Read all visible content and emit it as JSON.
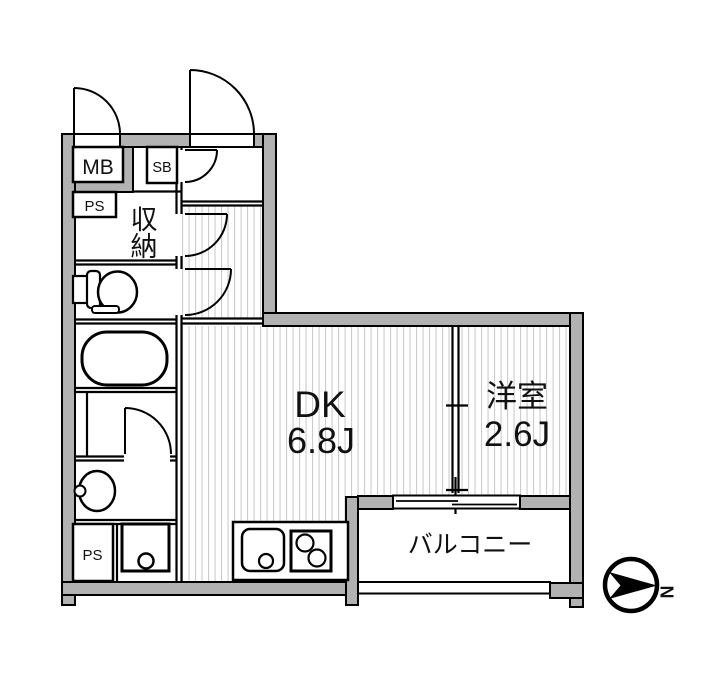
{
  "plan": {
    "rooms": {
      "dk": {
        "name": "DK",
        "size": "6.8J"
      },
      "western": {
        "name": "洋室",
        "size": "2.6J"
      },
      "balcony": {
        "name": "バルコニー"
      },
      "storage": {
        "char1": "収",
        "char2": "納"
      },
      "meter_box": "MB",
      "shoe_box": "SB",
      "pipe_space_upper": "PS",
      "pipe_space_lower": "PS"
    },
    "compass": {
      "north": "N"
    },
    "colors": {
      "wall": "#b2b2b2",
      "outline": "#000000",
      "floor_hatch": "#cccccc",
      "background": "#ffffff"
    }
  }
}
